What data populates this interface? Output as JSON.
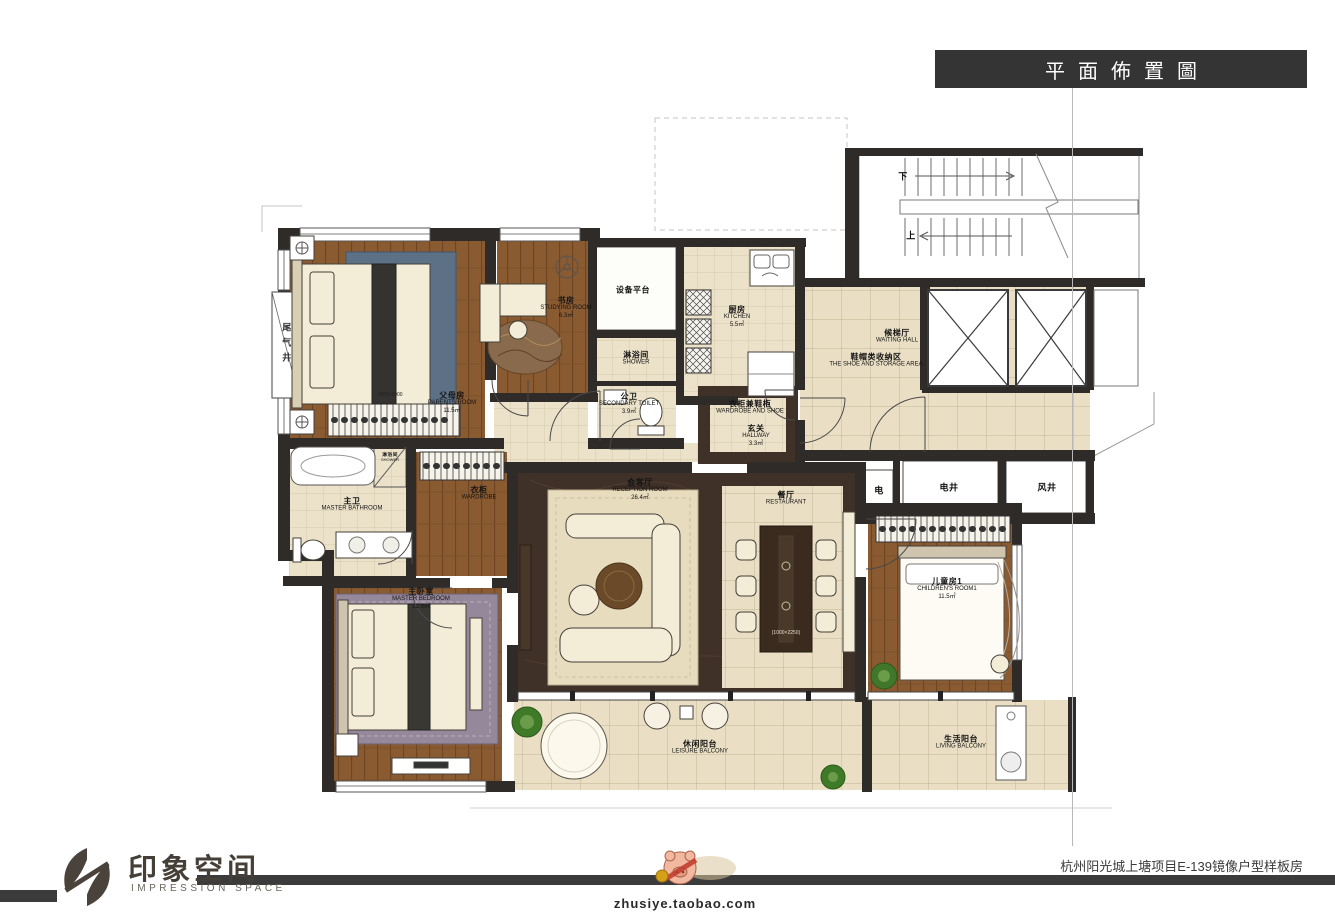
{
  "title_banner": "平面佈置圖",
  "plan": {
    "rooms": [
      {
        "id": "parents",
        "cn": "父母房",
        "en": "PARENTS ROOM",
        "area": "11.5㎡"
      },
      {
        "id": "study",
        "cn": "书房",
        "en": "STUDYING ROOM",
        "area": "6.3㎡"
      },
      {
        "id": "equipment",
        "cn": "设备平台",
        "en": "",
        "area": ""
      },
      {
        "id": "kitchen",
        "cn": "厨房",
        "en": "KITCHEN",
        "area": "5.5㎡"
      },
      {
        "id": "shower",
        "cn": "淋浴间",
        "en": "SHOWER",
        "area": ""
      },
      {
        "id": "secondary_toilet",
        "cn": "公卫",
        "en": "SECONDARY TOILET",
        "area": "3.9㎡"
      },
      {
        "id": "wardrobe_shoe",
        "cn": "衣柜兼鞋柜",
        "en": "WARDROBE AND SHOE",
        "area": ""
      },
      {
        "id": "hallway",
        "cn": "玄关",
        "en": "HALLWAY",
        "area": "3.3㎡"
      },
      {
        "id": "waiting_hall",
        "cn": "候梯厅",
        "en": "WAITING HALL",
        "area": ""
      },
      {
        "id": "shoe_storage",
        "cn": "鞋帽类收纳区",
        "en": "THE SHOE AND STORAGE AREA",
        "area": ""
      },
      {
        "id": "reception",
        "cn": "会客厅",
        "en": "RECEPTION ROOM",
        "area": "26.4㎡"
      },
      {
        "id": "restaurant",
        "cn": "餐厅",
        "en": "RESTAURANT",
        "area": ""
      },
      {
        "id": "master_bathroom",
        "cn": "主卫",
        "en": "MASTER BATHROOM",
        "area": ""
      },
      {
        "id": "shower_stall",
        "cn": "淋浴间",
        "en": "SHOWER",
        "area": ""
      },
      {
        "id": "wardrobe",
        "cn": "衣柜",
        "en": "WARDROBE",
        "area": ""
      },
      {
        "id": "master_bedroom",
        "cn": "主卧室",
        "en": "MASTER BEDROOM",
        "area": "12.9㎡"
      },
      {
        "id": "children_room",
        "cn": "儿童房1",
        "en": "CHILDREN'S ROOM1",
        "area": "11.5㎡"
      },
      {
        "id": "leisure_balcony",
        "cn": "休闲阳台",
        "en": "LEISURE BALCONY",
        "area": ""
      },
      {
        "id": "living_balcony",
        "cn": "生活阳台",
        "en": "LIVING BALCONY",
        "area": ""
      }
    ],
    "shafts": {
      "exhaust": "尾气井",
      "electric": "电",
      "electric_shaft": "电井",
      "wind_shaft": "风井"
    },
    "stairs": {
      "down": "下",
      "up": "上"
    },
    "dims": {
      "parents_bed": "1800×2000",
      "dining_table": "(1000×2250)"
    }
  },
  "footer": {
    "logo_cn": "印象空间",
    "logo_en": "IMPRESSION SPACE",
    "watermark_url": "zhusiye.taobao.com",
    "project": "杭州阳光城上塘项目E-139镜像户型样板房"
  },
  "colors": {
    "wall": "#2e2b28",
    "wood_floor": "#8a5a31",
    "tile_floor": "#eadfc4",
    "dark_marble": "#3f3028",
    "banner_bg": "#343434",
    "logo": "#4a433b",
    "rug_blue": "#5c7186",
    "rug_purple": "#96889b"
  }
}
